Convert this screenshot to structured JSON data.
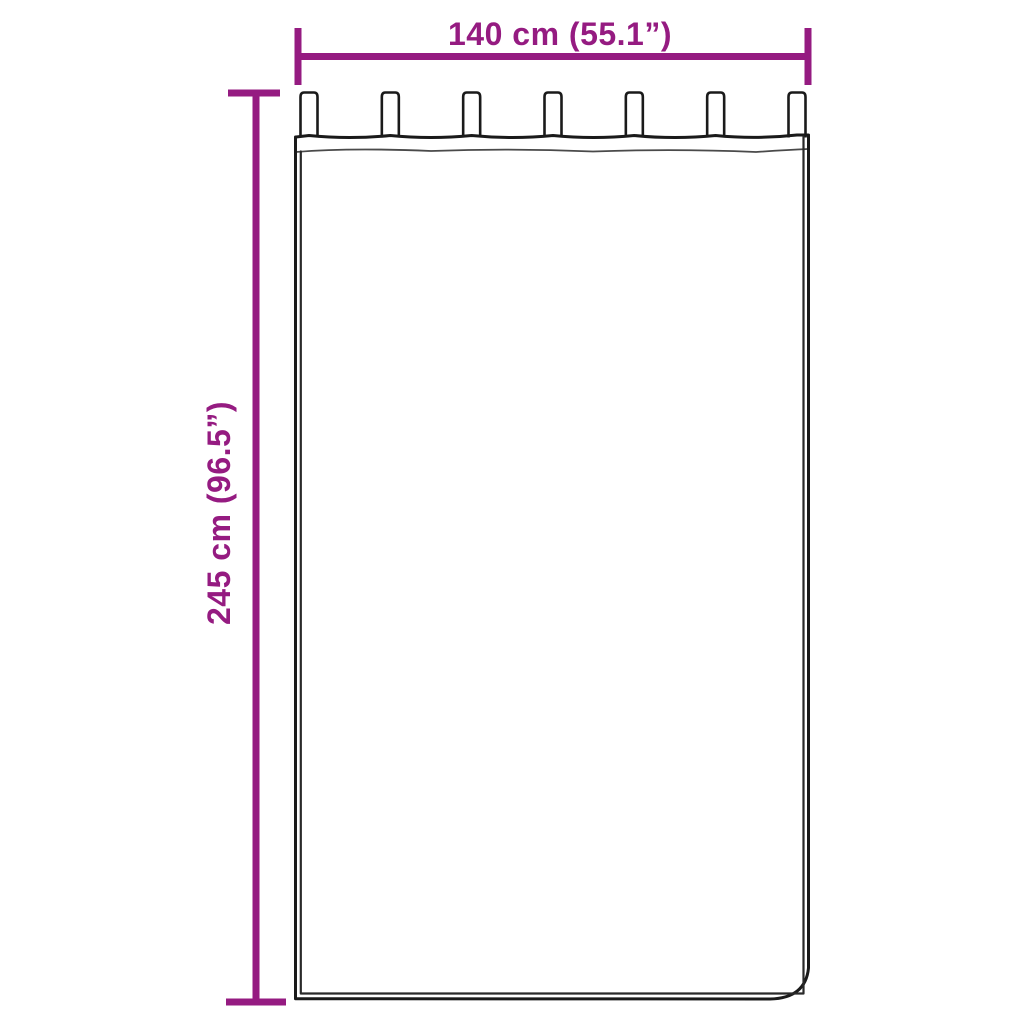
{
  "title": "Curtain size diagram",
  "dimensions": {
    "width": {
      "label": "140 cm (55.1”)",
      "value_cm": 140,
      "value_inches": 55.1
    },
    "height": {
      "label": "245 cm (96.5”)",
      "value_cm": 245,
      "value_inches": 96.5
    }
  },
  "curtain": {
    "style": "tab-top curtain panel",
    "tab_count": 7
  },
  "colors": {
    "dimension": "#951B81",
    "outline": "#1A1A1A",
    "background": "#FFFFFF"
  }
}
